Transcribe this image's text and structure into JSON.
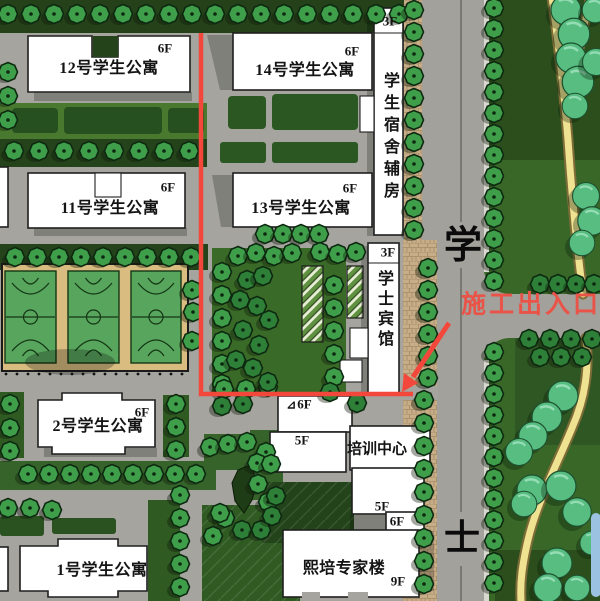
{
  "buildings": {
    "apt12": {
      "name": "12号学生公寓",
      "floor": "6F"
    },
    "apt14": {
      "name": "14号学生公寓",
      "floor": "6F"
    },
    "apt11": {
      "name": "11号学生公寓",
      "floor": "6F"
    },
    "apt13": {
      "name": "13号学生公寓",
      "floor": "6F"
    },
    "dorm_aux": {
      "name": "学生宿舍辅房",
      "floor": "3F"
    },
    "hotel": {
      "name": "学士宾馆",
      "floor": "3F"
    },
    "apt2": {
      "name": "2号学生公寓",
      "floor": "6F"
    },
    "apt1": {
      "name": "1号学生公寓"
    },
    "training": {
      "name": "培训中心",
      "entrance_mark": "⊿",
      "floor_top": "6F",
      "floor_mid": "5F",
      "floor_low": "5F",
      "floor_bottom": "6F"
    },
    "expert": {
      "name": "熙培专家楼",
      "floor": "9F"
    }
  },
  "road": {
    "label_top": "学",
    "label_bottom": "士"
  },
  "annotation": {
    "label": "施工出入口"
  },
  "colors": {
    "route_red": "#f4473c",
    "annotation_red": "#ea5348",
    "lawn_green": "#3a6a27",
    "dark_green": "#24431a",
    "court_green": "#58a55e",
    "court_base": "#d9bc80",
    "path_yellow": "#efe291",
    "water_blue": "#9cc2e2",
    "road_gray": "#a5a49e"
  }
}
